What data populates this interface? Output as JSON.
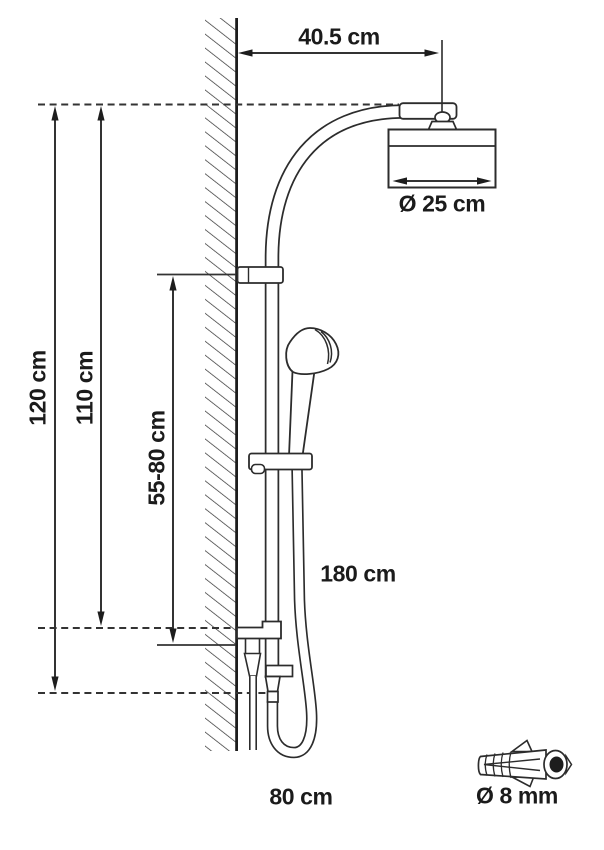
{
  "page": {
    "background": "#ffffff",
    "kind": "technical installation drawing",
    "subject": "shower column with overhead shower, hand shower, hose and wall plug"
  },
  "labels": {
    "wall_offset": "40.5 cm",
    "head_diameter": "Ø 25 cm",
    "total_height": "120 cm",
    "upper_height": "110 cm",
    "slider_range": "55-80 cm",
    "hose_length": "180 cm",
    "supply_height": "80 cm",
    "anchor_diameter": "Ø 8 mm"
  },
  "colors": {
    "structure_line": "#2c2c2c",
    "dimension_line": "#3a3a3a",
    "text": "#1b1b1b",
    "background": "#ffffff"
  }
}
